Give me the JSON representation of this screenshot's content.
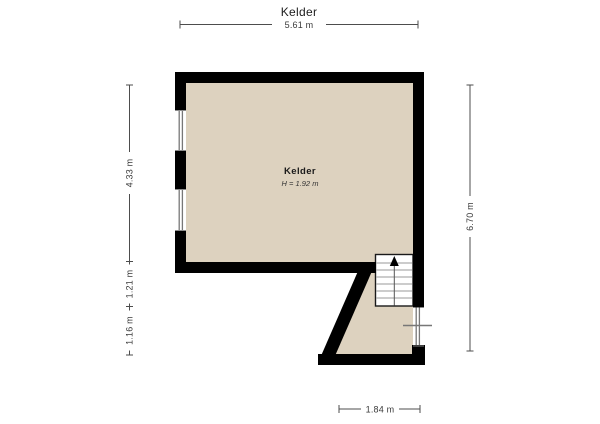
{
  "header": {
    "title": "Kelder"
  },
  "room": {
    "name": "Kelder",
    "height": "H = 1.92 m"
  },
  "dimensions": {
    "top": "5.61 m",
    "left_top": "4.33 m",
    "left_middle": "1.21 m",
    "left_bottom": "1.16 m",
    "right": "6.70 m",
    "bottom": "1.84 m"
  },
  "colors": {
    "background": "#ffffff",
    "floor": "#DDD2BF",
    "wall": "#000000",
    "dimension": "#4d4d4d",
    "stair_tread": "#999999",
    "window_glazing": "#777777"
  },
  "icons": {
    "stair_direction": "up-arrow"
  }
}
